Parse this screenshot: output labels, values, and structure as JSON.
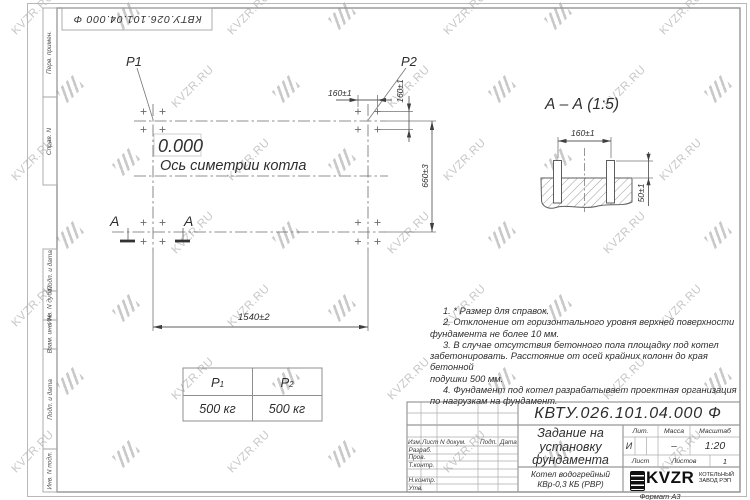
{
  "watermark": {
    "text": "KVZR.RU"
  },
  "top_stamp": {
    "designation": "КВТУ.026.101.04.000  Ф"
  },
  "margin_labels": [
    "Перв. примен.",
    "Справ. N",
    "Подп. и дата",
    "Инв. N дубл.",
    "Взам. инв. N",
    "Подп. и дата",
    "Инв. N подл."
  ],
  "plan": {
    "p1_label": "P1",
    "p2_label": "P2",
    "elevation": "0.000",
    "axis_label": "Ось симетрии котла",
    "dim_160_top": "160±1",
    "dim_160_side": "160±1",
    "dim_660": "660±3",
    "dim_1540": "1540±2",
    "section_letter_left": "A",
    "section_letter_right": "A"
  },
  "section_view": {
    "title": "А – А (1:5)",
    "dim_160": "160±1",
    "dim_50": "50±1"
  },
  "load_table": {
    "col1": {
      "base": "P",
      "sub": "1"
    },
    "col2": {
      "base": "P",
      "sub": "2"
    },
    "val1": "500 кг",
    "val2": "500 кг"
  },
  "notes": {
    "lines": [
      "1. * Размер для справок.",
      "2. Отклонение от горизонтального уровня верхней поверхности",
      "фундамента не более 10 мм.",
      "3. В случае отсутствия бетонного пола площадку под котел",
      "забетонировать. Расстояние от осей крайних колонн до края бетонной",
      "подушки 500 мм.",
      "4. Фундамент под котел разрабатывает проектная организация",
      "по нагрузкам на фундамент."
    ]
  },
  "title_block": {
    "designation": "КВТУ.026.101.04.000  Ф",
    "doc_title": {
      "line1": "Задание на",
      "line2": "установку",
      "line3": "фундамента"
    },
    "product": {
      "line1": "Котел водогрейный",
      "line2": "КВр-0,3 КБ (РВР)"
    },
    "cols": {
      "izm": "Изм.",
      "list": "Лист",
      "ndok": "N докум.",
      "podp": "Подп.",
      "data": "Дата"
    },
    "rows": {
      "razrab": "Разраб.",
      "prov": "Пров.",
      "tkontr": "Т.контр.",
      "nkontr": "Н.контр.",
      "utv": "Утв."
    },
    "right": {
      "lit_h": "Лит.",
      "massa_h": "Масса",
      "masshtab_h": "Масштаб",
      "lit": "И",
      "massa": "–",
      "masshtab": "1:20",
      "list_h": "Лист",
      "listov_h": "Листов",
      "listov": "1"
    },
    "logo": {
      "name": "KVZR",
      "sub1": "КОТЕЛЬНЫЙ",
      "sub2": "ЗАВОД РЭП"
    },
    "format": "Формат А3"
  }
}
